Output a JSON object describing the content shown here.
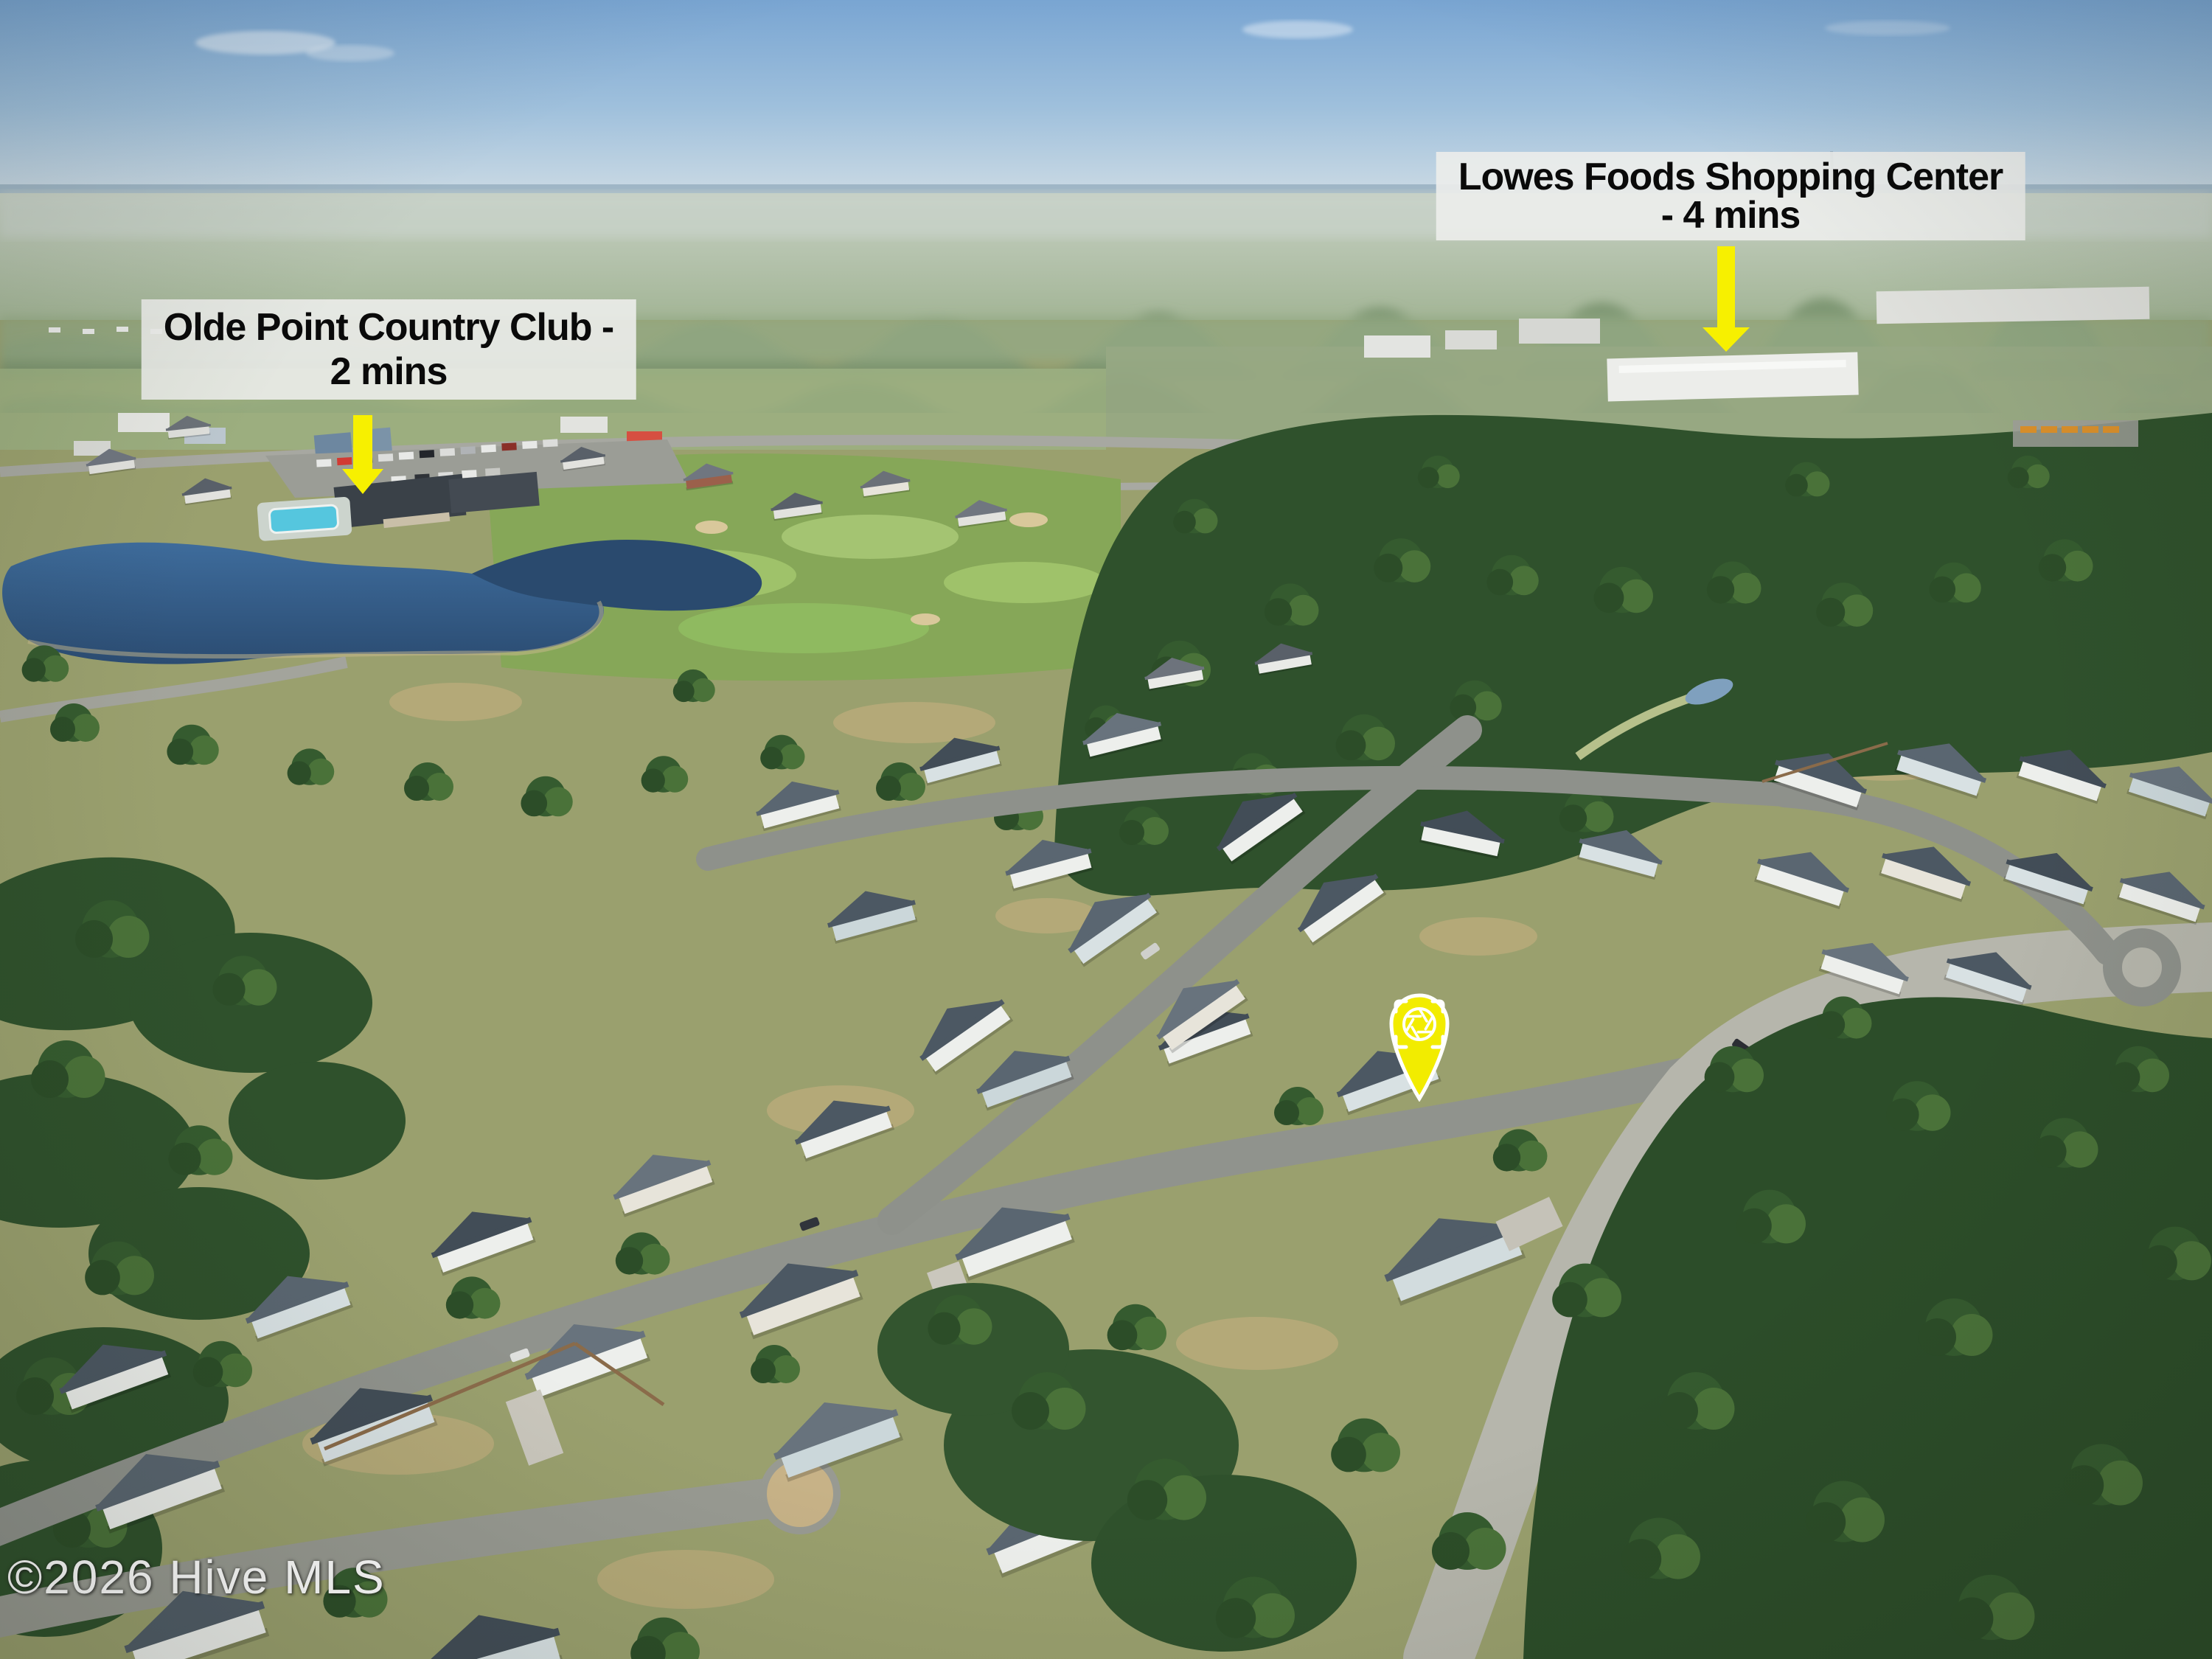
{
  "annotations": {
    "olde_point": {
      "line1": "Olde Point Country Club -",
      "line2": "2 mins",
      "arrow": "yellow-down-arrow"
    },
    "lowes": {
      "line1": "Lowes Foods Shopping Center",
      "line2": "- 4 mins",
      "arrow": "yellow-down-arrow"
    }
  },
  "pin": {
    "icon": "camera-aperture-icon",
    "shape": "map-pin"
  },
  "watermark": {
    "text": "©2026 Hive MLS"
  },
  "colors": {
    "label_background": "#ECEDEB",
    "label_text": "#0A0A0A",
    "arrow_yellow": "#F7F000",
    "pin_yellow": "#F2EC00",
    "pin_icon": "#FFFFFF",
    "watermark_text": "#FFFFFF",
    "sky_top": "#79A5D2",
    "sky_horizon": "#CBDAE4",
    "forest_green": "#2F512C",
    "lawn_olive": "#9AA06E",
    "road_gray": "#90938D",
    "pond_blue": "#2B4C72",
    "pool_cyan": "#55C6DE",
    "roof_slate": "#515D68",
    "wall_white": "#EDEFEC"
  }
}
